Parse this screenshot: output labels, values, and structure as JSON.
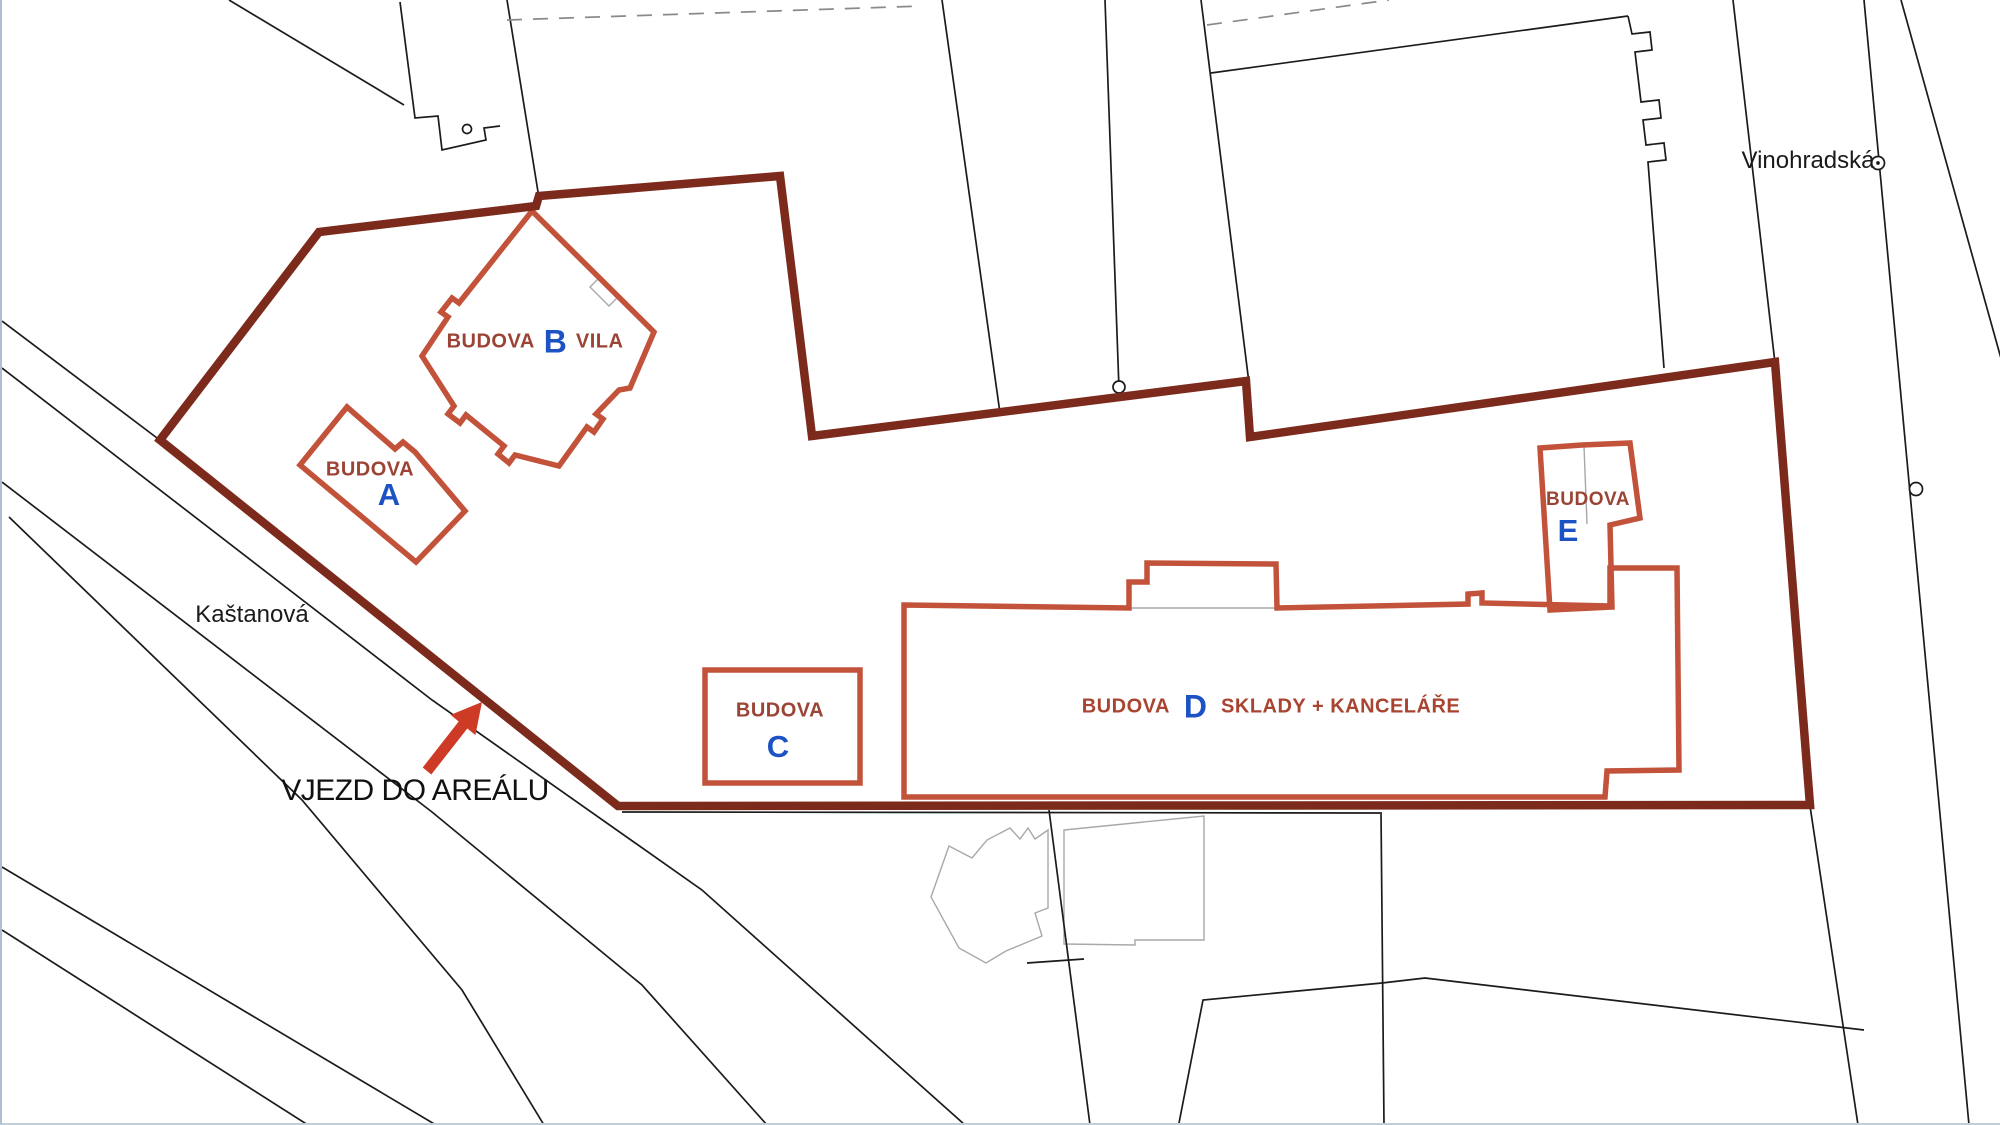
{
  "map": {
    "type": "cadastral-site-plan",
    "buildings": {
      "a": {
        "prefix": "BUDOVA",
        "letter": "A"
      },
      "b": {
        "prefix": "BUDOVA",
        "letter": "B",
        "suffix": "VILA"
      },
      "c": {
        "prefix": "BUDOVA",
        "letter": "C"
      },
      "d": {
        "prefix": "BUDOVA",
        "letter": "D",
        "suffix": "SKLADY + KANCELÁŘE"
      },
      "e": {
        "prefix": "BUDOVA",
        "letter": "E"
      }
    },
    "streets": {
      "kastanova": "Kaštanová",
      "vinohradska": "Vinohradská"
    },
    "annotations": {
      "entrance": "VJEZD DO AREÁLU"
    },
    "icons": {
      "survey_points": "survey-point-circle-icon",
      "entrance_arrow": "arrow-up-right-icon"
    },
    "colors": {
      "background": "#FFFFFF",
      "site_boundary": "#7C2A1C",
      "building_outline": "#C2523A",
      "building_label_brown": "#9B4436",
      "building_letter_blue": "#1C52C4",
      "suffix_red_brown": "#A84430",
      "entrance_arrow": "#CD3B27",
      "parcel_line_black": "#1b1b1b",
      "parcel_line_gray": "#a6a6a6"
    }
  }
}
